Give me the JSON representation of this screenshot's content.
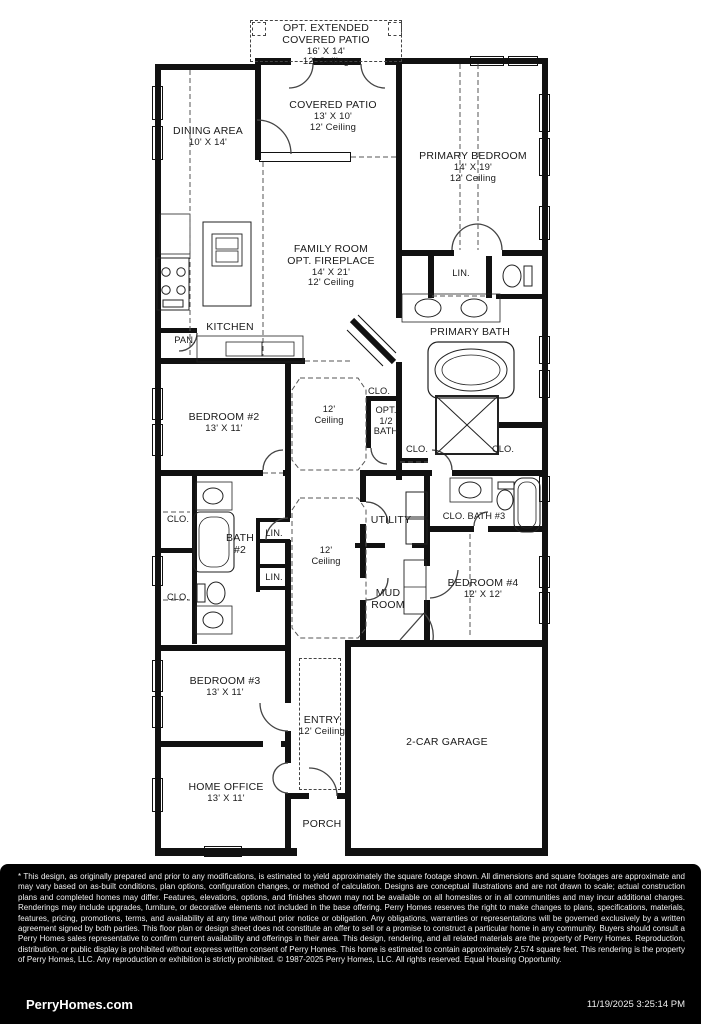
{
  "rooms": {
    "opt_extended_patio": {
      "l1": "OPT. EXTENDED",
      "l2": "COVERED PATIO",
      "dims": "16' X 14'",
      "ceiling": "12' Ceiling"
    },
    "covered_patio": {
      "name": "COVERED PATIO",
      "dims": "13' X 10'",
      "ceiling": "12' Ceiling"
    },
    "dining": {
      "name": "DINING AREA",
      "dims": "10' X 14'"
    },
    "primary_bedroom": {
      "name": "PRIMARY BEDROOM",
      "dims": "14' X 19'",
      "ceiling": "12' Ceiling"
    },
    "family_room": {
      "name": "FAMILY ROOM",
      "opt": "OPT. FIREPLACE",
      "dims": "14' X 21'",
      "ceiling": "12' Ceiling"
    },
    "kitchen": {
      "name": "KITCHEN"
    },
    "pantry": {
      "name": "PAN."
    },
    "linen_primary": {
      "name": "LIN."
    },
    "primary_bath": {
      "name": "PRIMARY BATH"
    },
    "hall_ceiling_upper": {
      "l1": "12'",
      "l2": "Ceiling"
    },
    "clo_hall": {
      "name": "CLO."
    },
    "opt_half_bath": {
      "l1": "OPT.",
      "l2": "1/2",
      "l3": "BATH"
    },
    "clo_half_bath": {
      "name": "CLO."
    },
    "clo_primary": {
      "name": "CLO."
    },
    "bedroom2": {
      "name": "BEDROOM #2",
      "dims": "13' X 11'"
    },
    "clo_left_upper": {
      "name": "CLO."
    },
    "bath2": {
      "l1": "BATH",
      "l2": "#2"
    },
    "linen_top": {
      "name": "LIN."
    },
    "linen_bottom": {
      "name": "LIN."
    },
    "clo_left_lower": {
      "name": "CLO."
    },
    "utility": {
      "name": "UTILITY"
    },
    "clo_bath3": {
      "name": "CLO. BATH #3"
    },
    "hall_ceiling_lower": {
      "l1": "12'",
      "l2": "Ceiling"
    },
    "mud_room": {
      "l1": "MUD",
      "l2": "ROOM"
    },
    "bedroom4": {
      "name": "BEDROOM #4",
      "dims": "12' X 12'"
    },
    "bedroom3": {
      "name": "BEDROOM #3",
      "dims": "13' X 11'"
    },
    "entry": {
      "name": "ENTRY",
      "ceiling": "12' Ceiling"
    },
    "garage": {
      "name": "2-CAR GARAGE"
    },
    "home_office": {
      "name": "HOME OFFICE",
      "dims": "13' X 11'"
    },
    "porch": {
      "name": "PORCH"
    }
  },
  "footer": {
    "disclaimer": "* This design, as originally prepared and prior to any modifications, is estimated to yield approximately the square footage shown. All dimensions and square footages are approximate and may vary based on as-built conditions, plan options, configuration changes, or method of calculation. Designs are conceptual illustrations and are not drawn to scale; actual construction plans and completed homes may differ. Features, elevations, options, and finishes shown may not be available on all homesites or in all communities and may incur additional charges. Renderings may include upgrades, furniture, or decorative elements not included in the base offering. Perry Homes reserves the right to make changes to plans, specifications, materials, features, pricing, promotions, terms, and availability at any time without prior notice or obligation. Any obligations, warranties or representations will be governed exclusively by a written agreement signed by both parties. This floor plan or design sheet does not constitute an offer to sell or a promise to construct a particular home in any community. Buyers should consult a Perry Homes sales representative to confirm current availability and offerings in their area. This design, rendering, and all related materials are the property of Perry Homes. Reproduction, distribution, or public display is prohibited without express written consent of Perry Homes. This home is estimated to contain approximately 2,574 square feet. This rendering is the property of Perry Homes, LLC. Any reproduction or exhibition is strictly prohibited. © 1987-2025 Perry Homes, LLC. All rights reserved. Equal Housing Opportunity.",
    "brand": "PerryHomes.com",
    "timestamp": "11/19/2025 3:25:14 PM"
  }
}
